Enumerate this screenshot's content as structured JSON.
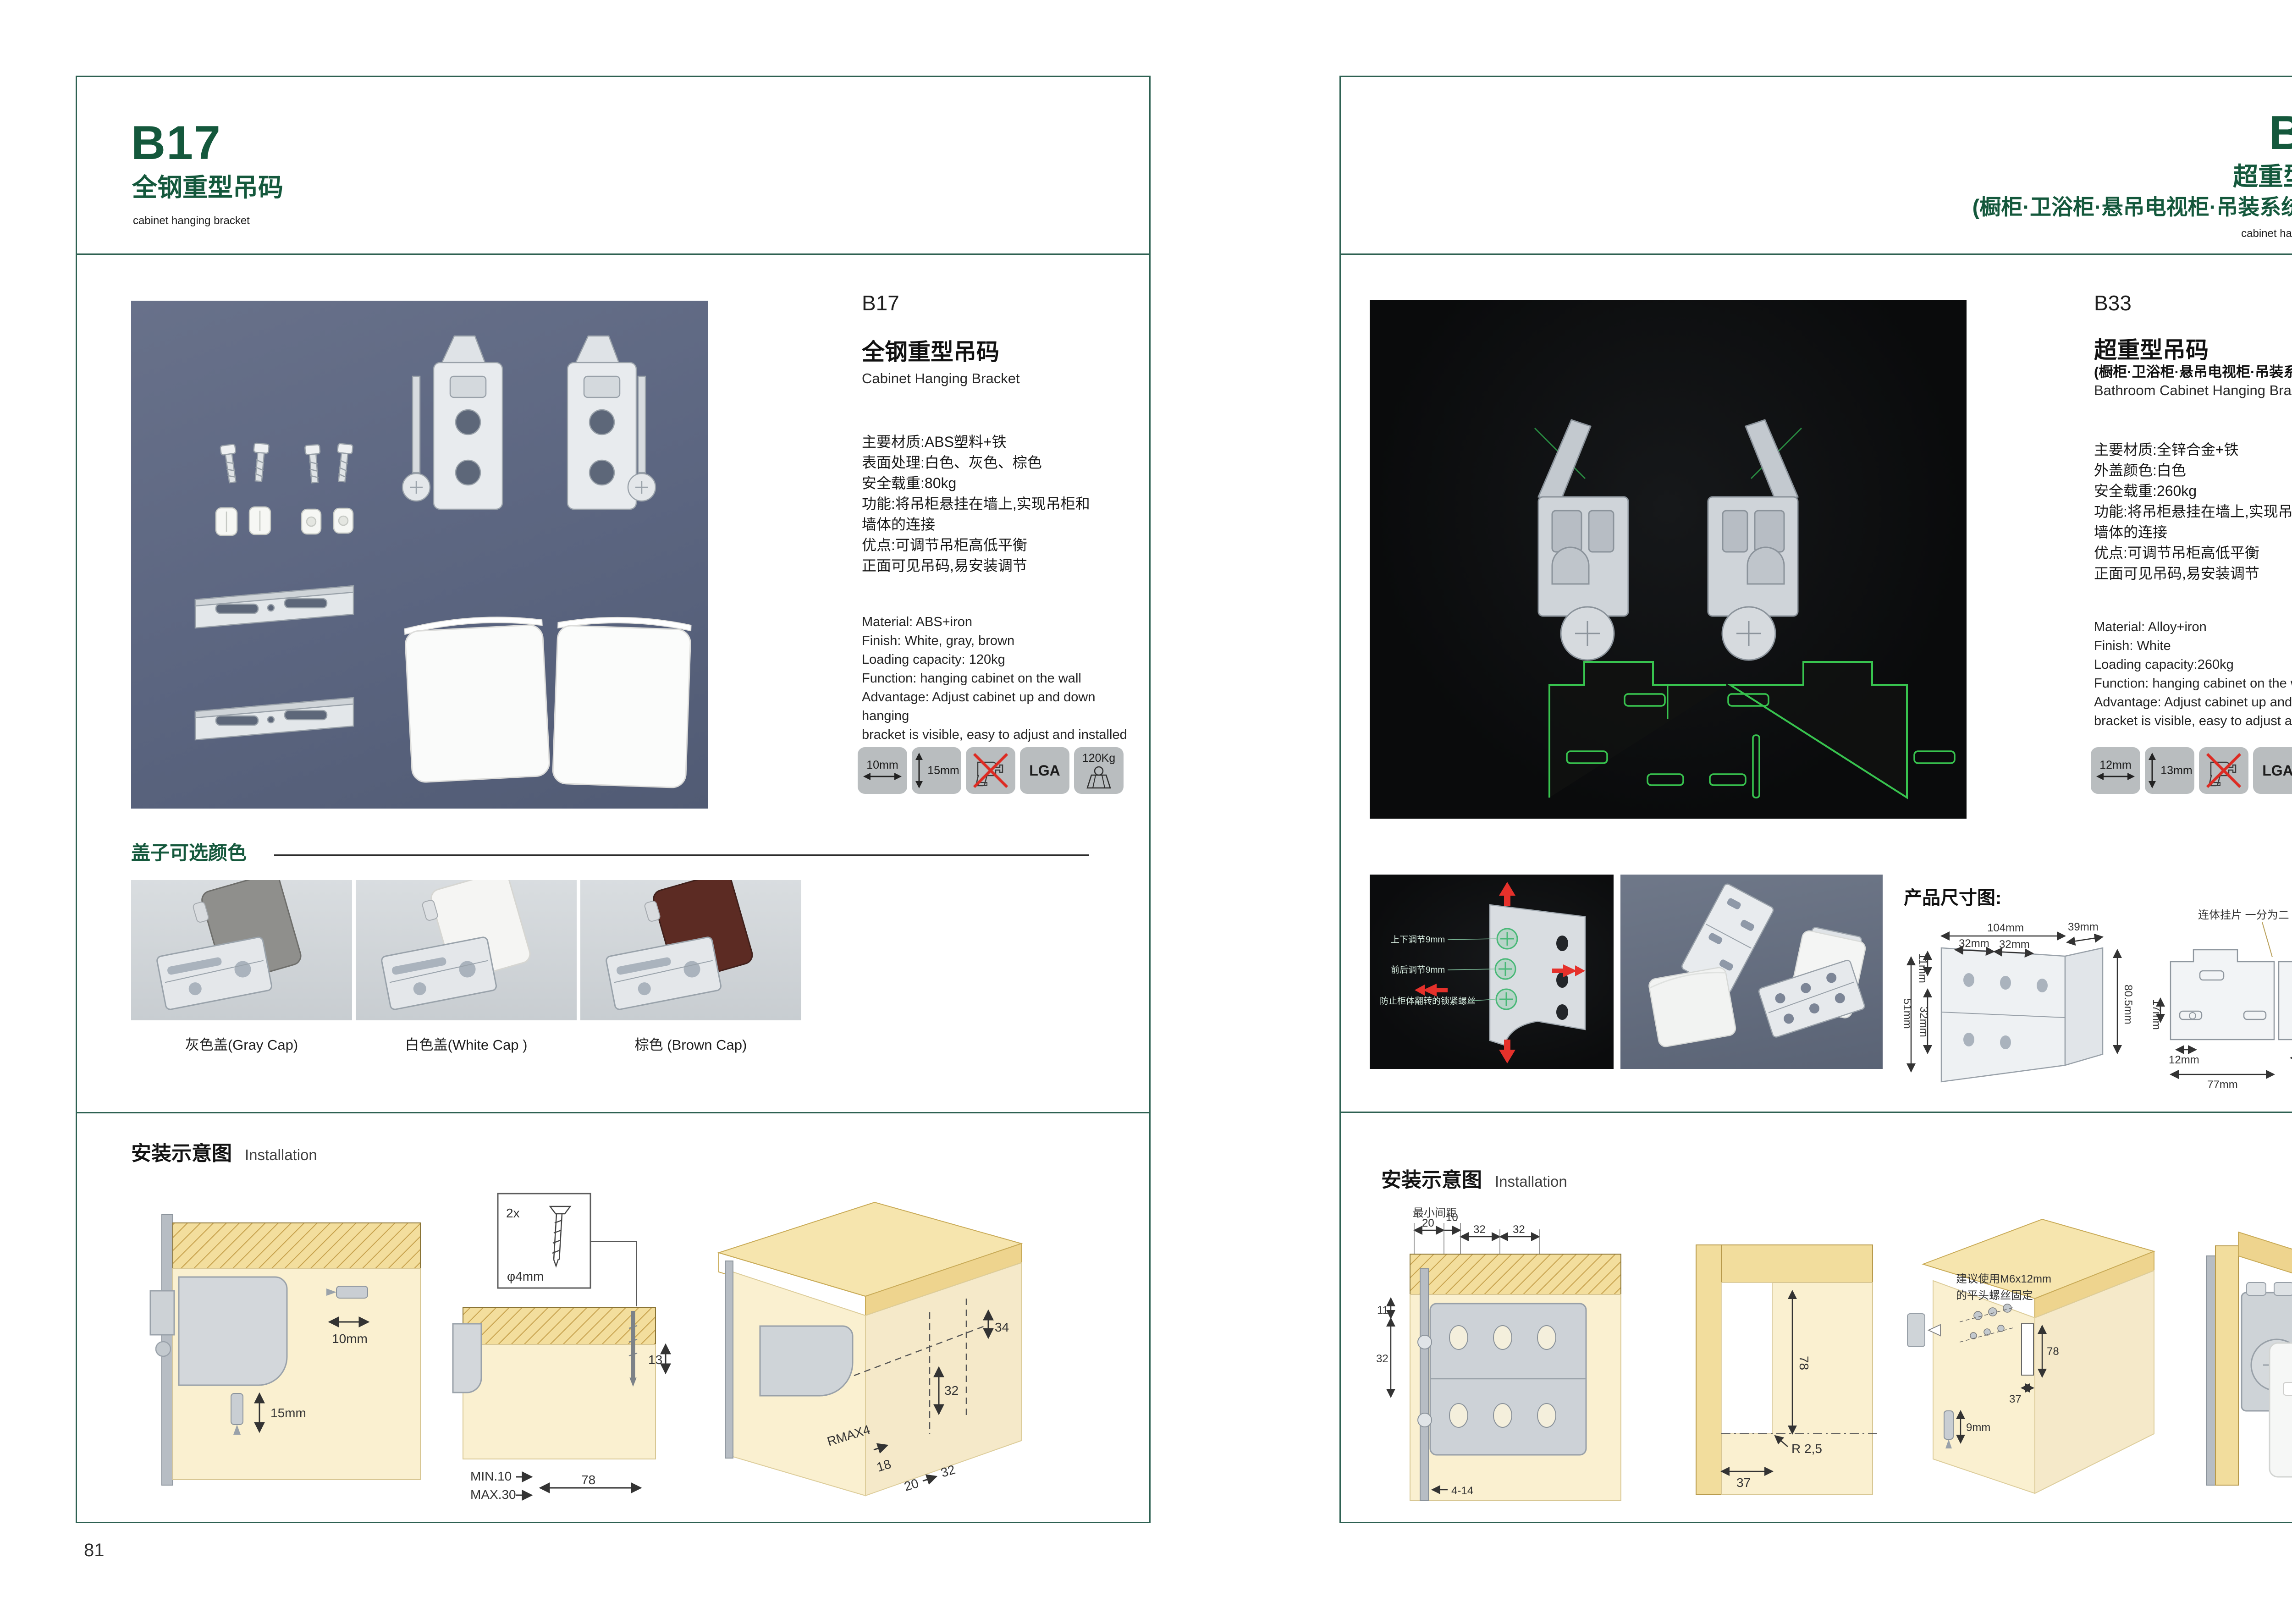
{
  "left": {
    "page_no": "81",
    "header": {
      "code": "B17",
      "title_cn": "全钢重型吊码",
      "subtitle_en": "cabinet hanging bracket"
    },
    "info": {
      "code": "B17",
      "name_cn": "全钢重型吊码",
      "name_en": "Cabinet Hanging Bracket",
      "specs_cn": [
        "主要材质:ABS塑料+铁",
        "表面处理:白色、灰色、棕色",
        "安全载重:80kg",
        "功能:将吊柜悬挂在墙上,实现吊柜和",
        "墙体的连接",
        "优点:可调节吊柜高低平衡",
        "正面可见吊码,易安装调节"
      ],
      "specs_en": [
        "Material: ABS+iron",
        "Finish: White, gray, brown",
        "Loading capacity: 120kg",
        "Function: hanging cabinet on the wall",
        "Advantage: Adjust cabinet up and down hanging",
        "bracket is visible, easy to adjust and installed"
      ]
    },
    "badges": {
      "width": "10mm",
      "height": "15mm",
      "cert": "LGA",
      "load": "120Kg"
    },
    "caps": {
      "heading": "盖子可选颜色",
      "items": [
        {
          "label": "灰色盖(Gray Cap)",
          "color": "#8f8f8c",
          "edge": "#6e6e6b"
        },
        {
          "label": "白色盖(White Cap )",
          "color": "#f5f5f3",
          "edge": "#d6d6d2"
        },
        {
          "label": "棕色 (Brown Cap)",
          "color": "#5c2b23",
          "edge": "#40201b"
        }
      ]
    },
    "install": {
      "heading_cn": "安装示意图",
      "heading_en": "Installation",
      "d1": {
        "w": "10mm",
        "h": "15mm"
      },
      "d2": {
        "qty": "2x",
        "dia": "φ4mm",
        "min": "MIN.10",
        "max": "MAX.30",
        "depth": "78",
        "side": "13"
      },
      "d3": {
        "a": "34",
        "b": "32",
        "r": "RMAX4",
        "c": "18",
        "d": "20",
        "e": "32"
      }
    }
  },
  "right": {
    "page_no": "82",
    "header": {
      "code": "B33",
      "title_cn": "超重型吊码",
      "title_sub": "(橱柜·卫浴柜·悬吊电视柜·吊装系统 专用)",
      "subtitle_en": "cabinet hanging bracket"
    },
    "info": {
      "code": "B33",
      "name_cn": "超重型吊码",
      "name_sub": "(橱柜·卫浴柜·悬吊电视柜·吊装系统 专用)",
      "name_en": "Bathroom Cabinet Hanging Bracket",
      "specs_cn": [
        "主要材质:全锌合金+铁",
        "外盖颜色:白色",
        "安全载重:260kg",
        "功能:将吊柜悬挂在墙上,实现吊柜和",
        "墙体的连接",
        "优点:可调节吊柜高低平衡",
        "正面可见吊码,易安装调节"
      ],
      "specs_en": [
        "Material: Alloy+iron",
        "Finish: White",
        "Loading capacity:260kg",
        "Function: hanging cabinet on the wall",
        "Advantage: Adjust cabinet up and down hanging",
        "bracket is visible, easy to adjust and installed"
      ]
    },
    "badges": {
      "width": "12mm",
      "height": "13mm",
      "cert": "LGA",
      "load": "260Kg"
    },
    "adjust": {
      "l1": "上下调节9mm",
      "l2": "前后调节9mm",
      "l3": "防止柜体翻转的锁紧螺丝"
    },
    "dims": {
      "heading": "产品尺寸图:",
      "left": {
        "top": "104mm",
        "s1": "32mm",
        "s2": "32mm",
        "side": "39mm",
        "height": "80.5mm",
        "v1": "11mm",
        "v2": "51mm",
        "v3": "32mm"
      },
      "right": {
        "label": "连体挂片 一分为二",
        "top": "55mm",
        "r1": "39mm",
        "r2": "55mm",
        "l1": "17mm",
        "b1": "12mm",
        "b2": "77mm",
        "b3": "63mm",
        "r3": "8mm"
      }
    },
    "install": {
      "heading_cn": "安装示意图",
      "heading_en": "Installation",
      "d1": {
        "t0": "最小间距",
        "t1": "20",
        "t2": "10",
        "t3": "32",
        "t4": "32",
        "l1": "11",
        "l2": "32",
        "b1": "4-14"
      },
      "d2": {
        "v": "78",
        "r": "R 2,5",
        "b": "37"
      },
      "d3": {
        "n1": "建议使用M6x12mm",
        "n2": "的平头螺丝固定",
        "v": "78",
        "b": "37",
        "s": "9mm"
      }
    }
  }
}
